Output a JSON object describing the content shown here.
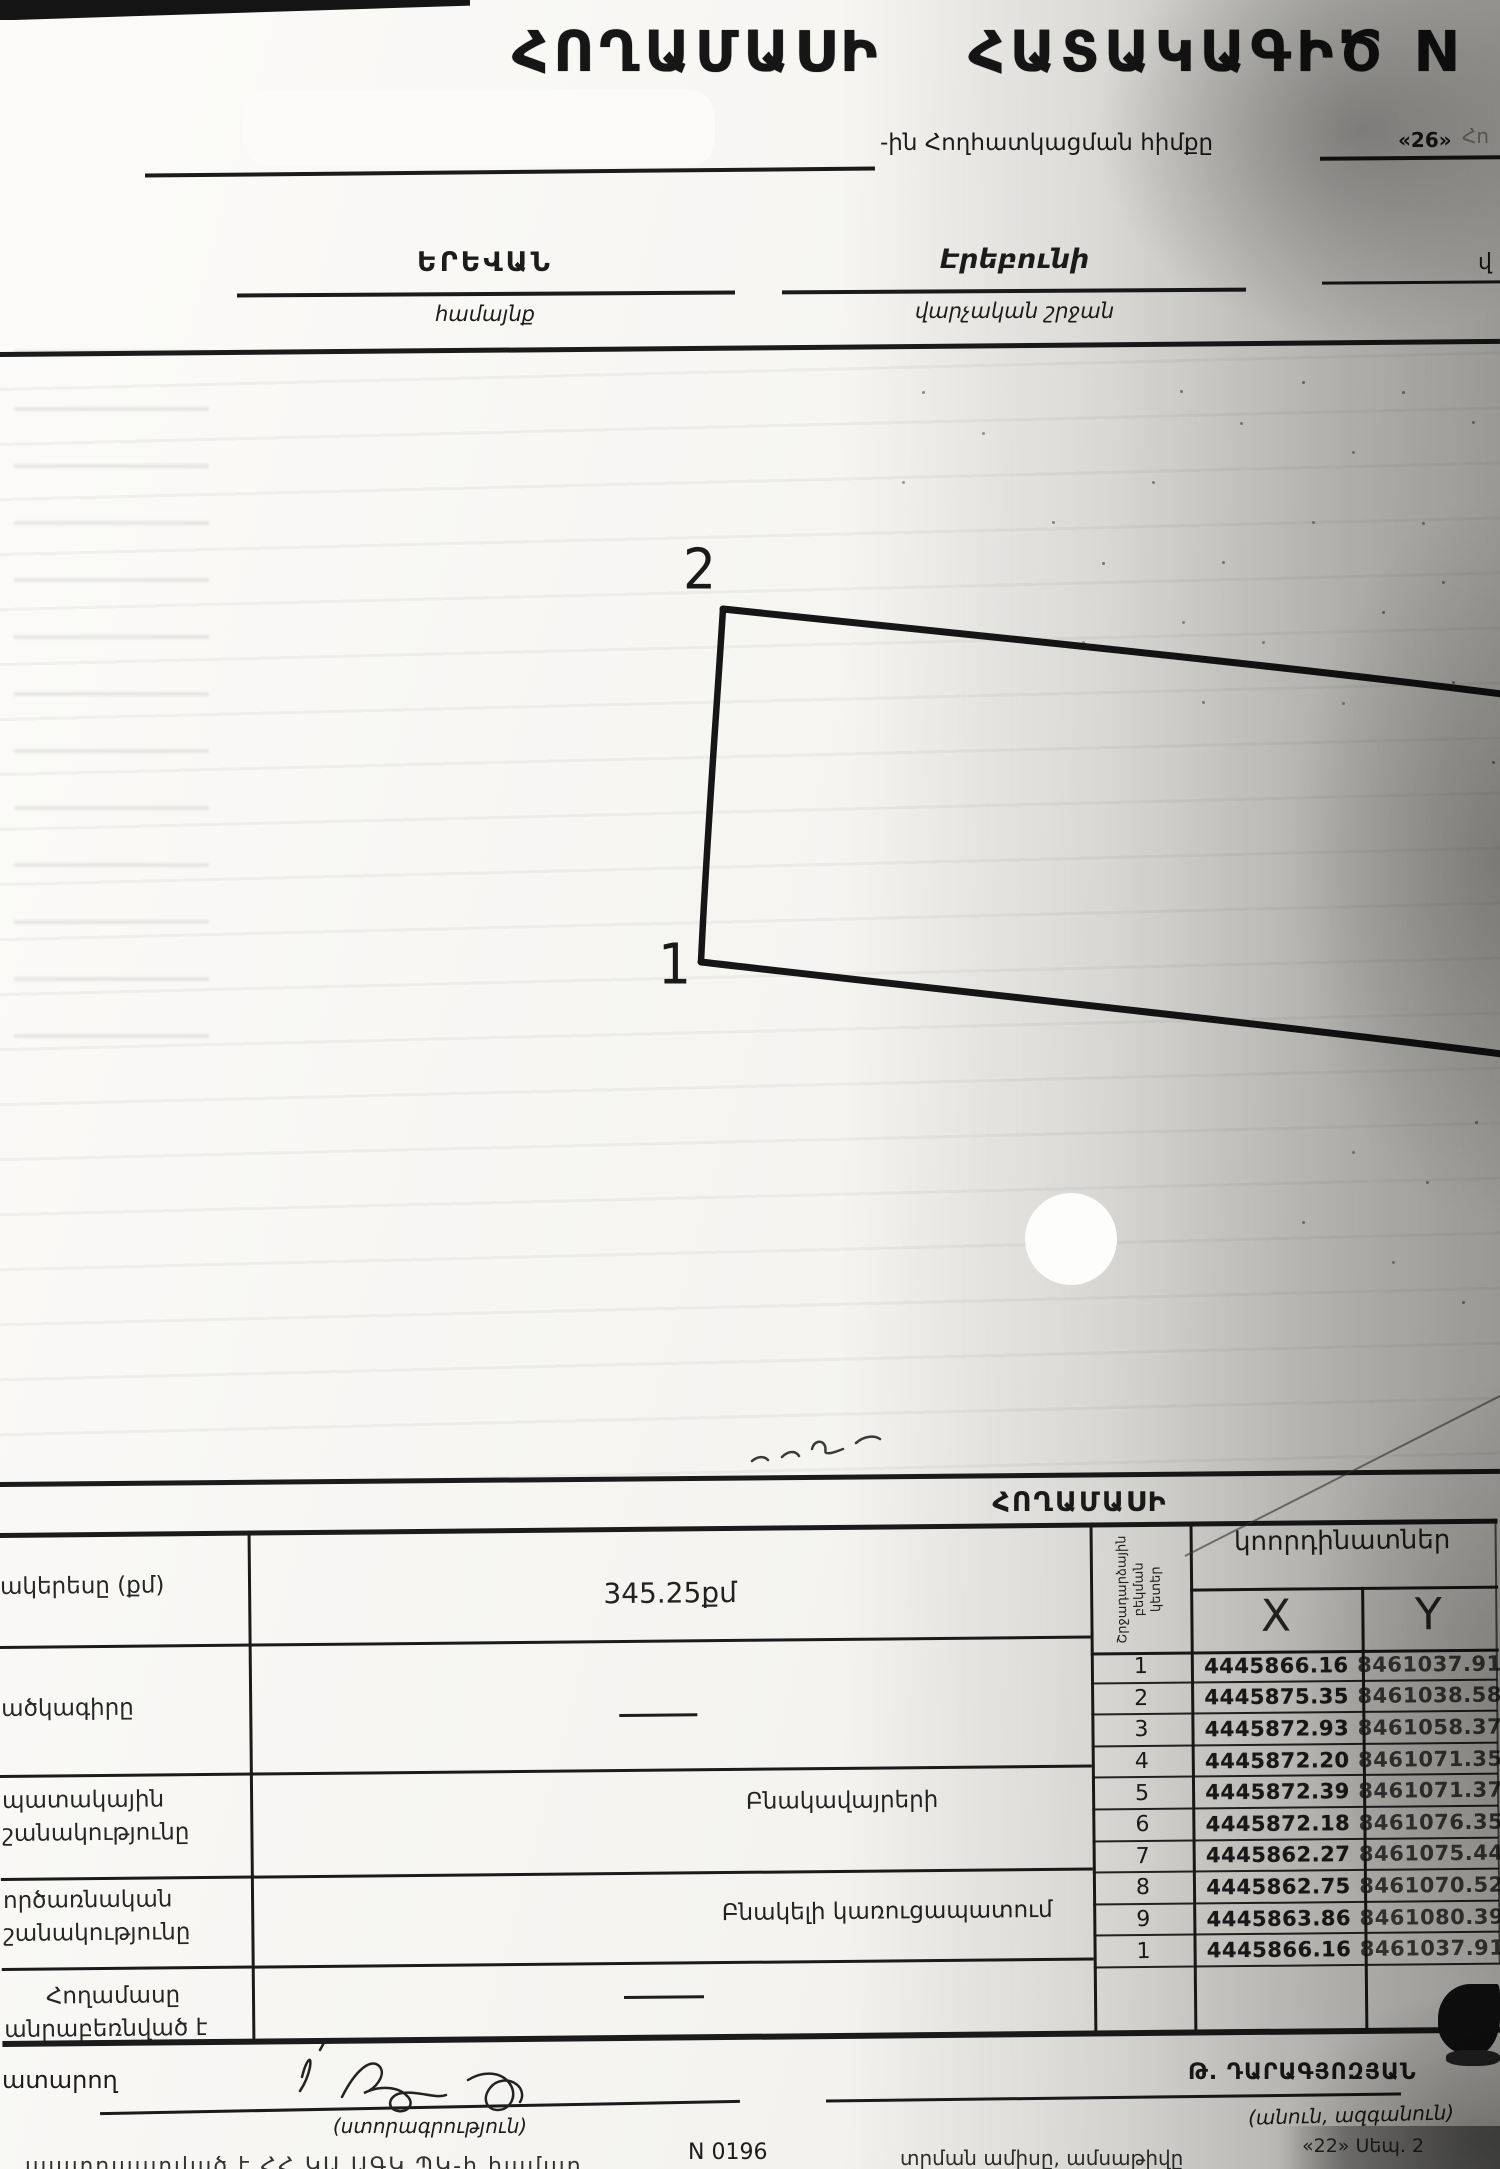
{
  "header": {
    "title_word1": "ՀՈՂԱՄԱՍԻ",
    "title_word2": "ՀԱՏԱԿԱԳԻԾ",
    "title_cut_letter": "N",
    "basis_label": "-ին Հողհատկացման հիմքը",
    "basis_number": "«26»",
    "basis_faint_fragment": "Հո",
    "community_value": "ԵՐԵՎԱՆ",
    "community_caption": "համայնք",
    "district_value": "Էրեբունի",
    "district_caption": "վարչական շրջան",
    "right_edge_fragment": "վ"
  },
  "plot": {
    "label_point_2": "2",
    "label_point_1": "1"
  },
  "section": {
    "title": "ՀՈՂԱՄԱՍԻ"
  },
  "info_table": {
    "rows": [
      {
        "label_line1": "ակերեսը (քմ)",
        "label_line2": "",
        "value": "345.25քմ"
      },
      {
        "label_line1": "ածկագիրը",
        "label_line2": "",
        "value": "—"
      },
      {
        "label_line1": "պատակային",
        "label_line2": "շանակությունը",
        "value": "Բնակավայրերի"
      },
      {
        "label_line1": "ործառնական",
        "label_line2": "շանակությունը",
        "value": "Բնակելի կառուցապատում"
      },
      {
        "label_line1": "Հողամասը",
        "label_line2": "անրաբեռնված է",
        "value": "—"
      }
    ]
  },
  "coord_table": {
    "corner_lines": [
      "Շրջադարձային",
      "բեկման",
      "կետեր"
    ],
    "header": "կոորդինատներ",
    "x_label": "X",
    "y_label": "Y",
    "rows": [
      {
        "point": "1",
        "x": "4445866.16",
        "y": "8461037.91"
      },
      {
        "point": "2",
        "x": "4445875.35",
        "y": "8461038.58"
      },
      {
        "point": "3",
        "x": "4445872.93",
        "y": "8461058.37"
      },
      {
        "point": "4",
        "x": "4445872.20",
        "y": "8461071.35"
      },
      {
        "point": "5",
        "x": "4445872.39",
        "y": "8461071.37"
      },
      {
        "point": "6",
        "x": "4445872.18",
        "y": "8461076.35"
      },
      {
        "point": "7",
        "x": "4445862.27",
        "y": "8461075.44"
      },
      {
        "point": "8",
        "x": "4445862.75",
        "y": "8461070.52"
      },
      {
        "point": "9",
        "x": "4445863.86",
        "y": "8461080.39"
      },
      {
        "point": "1",
        "x": "4445866.16",
        "y": "8461037.91"
      }
    ]
  },
  "footer": {
    "performer_label": "ատարող",
    "signature_caption": "(ստորագրություն)",
    "name_value": "Թ. ԴԱՐԱԳՅՈԶՅԱՆ",
    "name_caption": "(անուն, ազգանուն)",
    "form_number": "N 0196",
    "date_caption": "տրման ամիսը, ամսաթիվը",
    "date_value": "«22» Սեպ. 2",
    "bottom_left_text": "պատրաստված է ՀՀ ԿԱ ԱԳԿ ՊԿ-ի համար"
  }
}
